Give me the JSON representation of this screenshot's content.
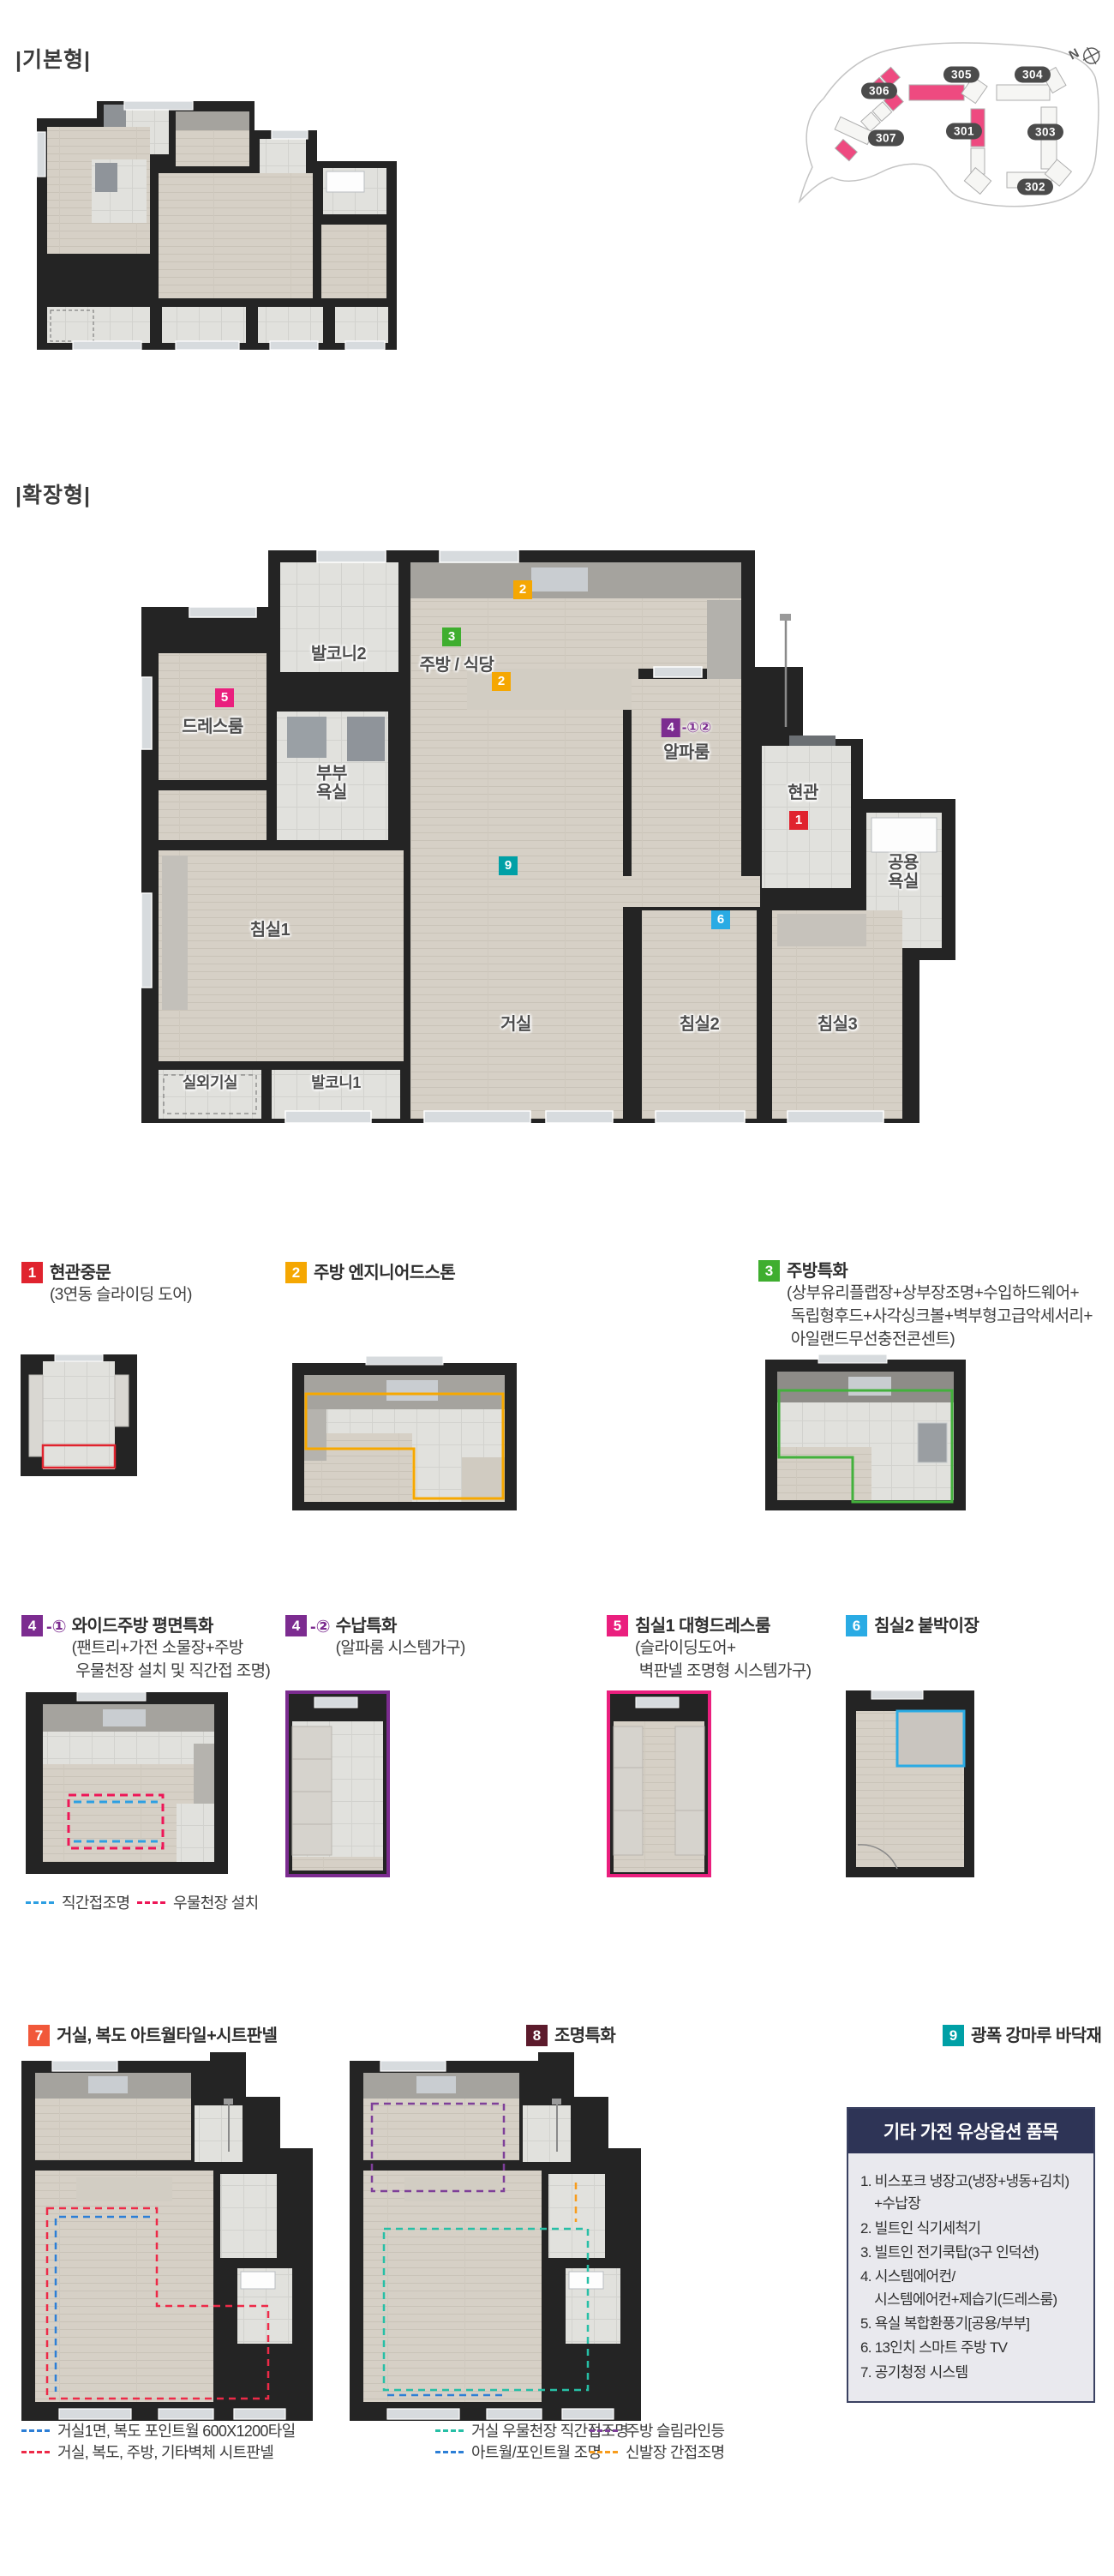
{
  "sections": {
    "basic": "|기본형|",
    "expanded": "|확장형|"
  },
  "site_map": {
    "compass": "N",
    "buildings": [
      "306",
      "305",
      "304",
      "307",
      "301",
      "303",
      "302"
    ]
  },
  "plan": {
    "rooms": {
      "balcony2": "발코니2",
      "dressroom": "드레스룸",
      "master_bath": "부부\n욕실",
      "kitchen": "주방 / 식당",
      "alpha": "알파룸",
      "entry": "현관",
      "common_bath": "공용\n욕실",
      "bed1": "침실1",
      "living": "거실",
      "bed2": "침실2",
      "bed3": "침실3",
      "outdoor_unit": "실외기실",
      "balcony1": "발코니1"
    },
    "markers": {
      "m1": "1",
      "m2": "2",
      "m3": "3",
      "m4": "4",
      "m4_suffix": "-①②",
      "m5": "5",
      "m6": "6",
      "m9": "9"
    }
  },
  "legend": [
    {
      "num": "1",
      "title": "현관중문",
      "subtitle": "(3연동 슬라이딩 도어)"
    },
    {
      "num": "2",
      "title": "주방 엔지니어드스톤",
      "subtitle": ""
    },
    {
      "num": "3",
      "title": "주방특화",
      "subtitle": "(상부유리플랩장+상부장조명+수입하드웨어+\n 독립형후드+사각싱크볼+벽부형고급악세서리+\n 아일랜드무선충전콘센트)"
    },
    {
      "num": "4",
      "suffix": "-①",
      "title": "와이드주방 평면특화",
      "subtitle": "(팬트리+가전 소물장+주방\n 우물천장 설치 및 직간접 조명)"
    },
    {
      "num": "4",
      "suffix": "-②",
      "title": "수납특화",
      "subtitle": "(알파룸 시스템가구)"
    },
    {
      "num": "5",
      "title": "침실1 대형드레스룸",
      "subtitle": "(슬라이딩도어+\n 벽판넬 조명형 시스템가구)"
    },
    {
      "num": "6",
      "title": "침실2 붙박이장",
      "subtitle": ""
    },
    {
      "num": "7",
      "title": "거실, 복도 아트월타일+시트판넬",
      "subtitle": ""
    },
    {
      "num": "8",
      "title": "조명특화",
      "subtitle": ""
    },
    {
      "num": "9",
      "title": "광폭 강마루 바닥재",
      "subtitle": ""
    }
  ],
  "legend4_sub": [
    "직간접조명",
    "우물천장 설치"
  ],
  "legend7_sub": [
    "거실1면, 복도 포인트월 600X1200타일",
    "거실, 복도, 주방, 기타벽체 시트판넬"
  ],
  "legend8_sub": [
    "거실 우물천장 직간접조명",
    "아트월/포인트월 조명",
    "주방 슬림라인등",
    "신발장 간접조명"
  ],
  "options_box": {
    "title": "기타 가전 유상옵션 품목",
    "items": [
      "1. 비스포크 냉장고(냉장+냉동+김치)\n    +수납장",
      "2. 빌트인 식기세척기",
      "3. 빌트인 전기쿡탑(3구 인덕션)",
      "4. 시스템에어컨/\n    시스템에어컨+제습기(드레스룸)",
      "5. 욕실 복합환풍기[공용/부부]",
      "6. 13인치 스마트 주방 TV",
      "7. 공기청정 시스템"
    ]
  },
  "colors": {
    "badge1": "#e0232e",
    "badge2": "#f5a702",
    "badge3": "#3fae2f",
    "badge4": "#7c2c90",
    "badge5": "#ea1f7e",
    "badge6": "#2aabe4",
    "badge7": "#f1583a",
    "badge8": "#5c1b2c",
    "badge9": "#00a0a6",
    "box_navy": "#2e3456",
    "leg_direct": "#2d9fe2",
    "leg_coffer": "#ee1657",
    "leg7_tile": "#2d7fd6",
    "leg7_sheet": "#ed2a48",
    "leg8_coffer": "#27bfa6",
    "leg8_artwall": "#2d7fd6",
    "leg8_slim": "#7e3f99",
    "leg8_shoe": "#f89c1c",
    "site_badge": "#4b4b4b",
    "site_highlight": "#ee4a80"
  }
}
